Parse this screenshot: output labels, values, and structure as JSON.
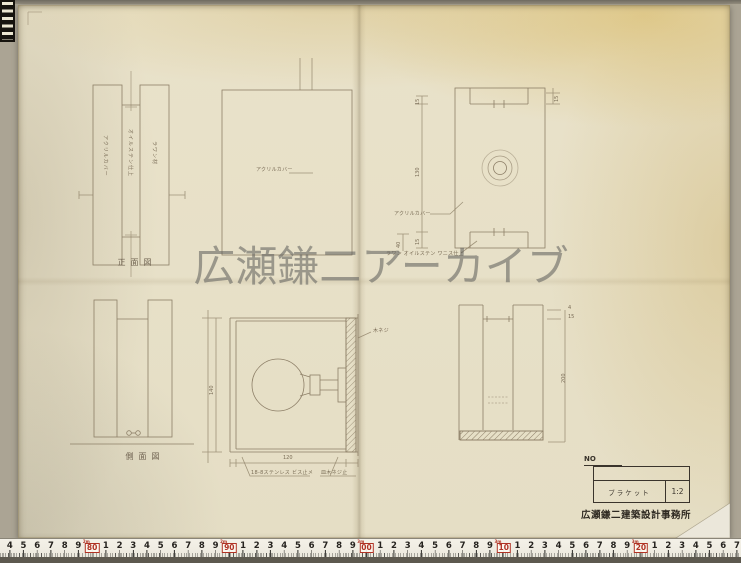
{
  "colors": {
    "paper": "#e7e0c8",
    "pencil_line": "#8d7f67",
    "ink": "#3a342c",
    "ruler_red": "#b03224",
    "watermark_gray": "#62625e"
  },
  "watermark": {
    "text": "広瀬鎌二アーカイブ"
  },
  "sheet": {
    "front_view": {
      "caption": "正面図",
      "label_left": "アクリルカバー",
      "label_center": "オイルステン仕上",
      "label_right": "ラワン材"
    },
    "side_view": {
      "caption": "側面図"
    },
    "cover_view": {
      "label": "アクリルカバー"
    },
    "plan_view": {
      "label": "アクリルカバー",
      "material_note": "ラワン オイルステン ワニス仕上",
      "dim_top": "15",
      "dim_mid": "130",
      "dim_bot": "15",
      "dim_small": "40",
      "dim_right": "15"
    },
    "bulb_section": {
      "screw_label": "木ネジ",
      "note_left": "18-8ステンレス ビス止メ",
      "note_right": "皿木ネジ止",
      "dim_height": "140",
      "dim_width": "120"
    },
    "side_section": {
      "dim_t1": "4",
      "dim_t2": "15",
      "dim_height": "200"
    }
  },
  "title_block": {
    "no_label": "NO",
    "title": "ブラケット",
    "scale": "1:2",
    "stamp": "広瀬鎌二建築設計事務所"
  },
  "ruler": {
    "sequence": [
      "4",
      "5",
      "6",
      "7",
      "8",
      "9",
      "80",
      "1",
      "2",
      "3",
      "4",
      "5",
      "6",
      "7",
      "8",
      "9",
      "90",
      "1",
      "2",
      "3",
      "4",
      "5",
      "6",
      "7",
      "8",
      "9",
      "00",
      "1",
      "2",
      "3",
      "4",
      "5",
      "6",
      "7",
      "8",
      "9",
      "10",
      "1",
      "2",
      "3",
      "4",
      "5",
      "6",
      "7",
      "8",
      "9",
      "20",
      "1",
      "2",
      "3",
      "4",
      "5",
      "6",
      "7"
    ],
    "meter_labels": {
      "6": "2m",
      "16": "2m",
      "26": "3m",
      "36": "3m",
      "46": "3m"
    }
  }
}
